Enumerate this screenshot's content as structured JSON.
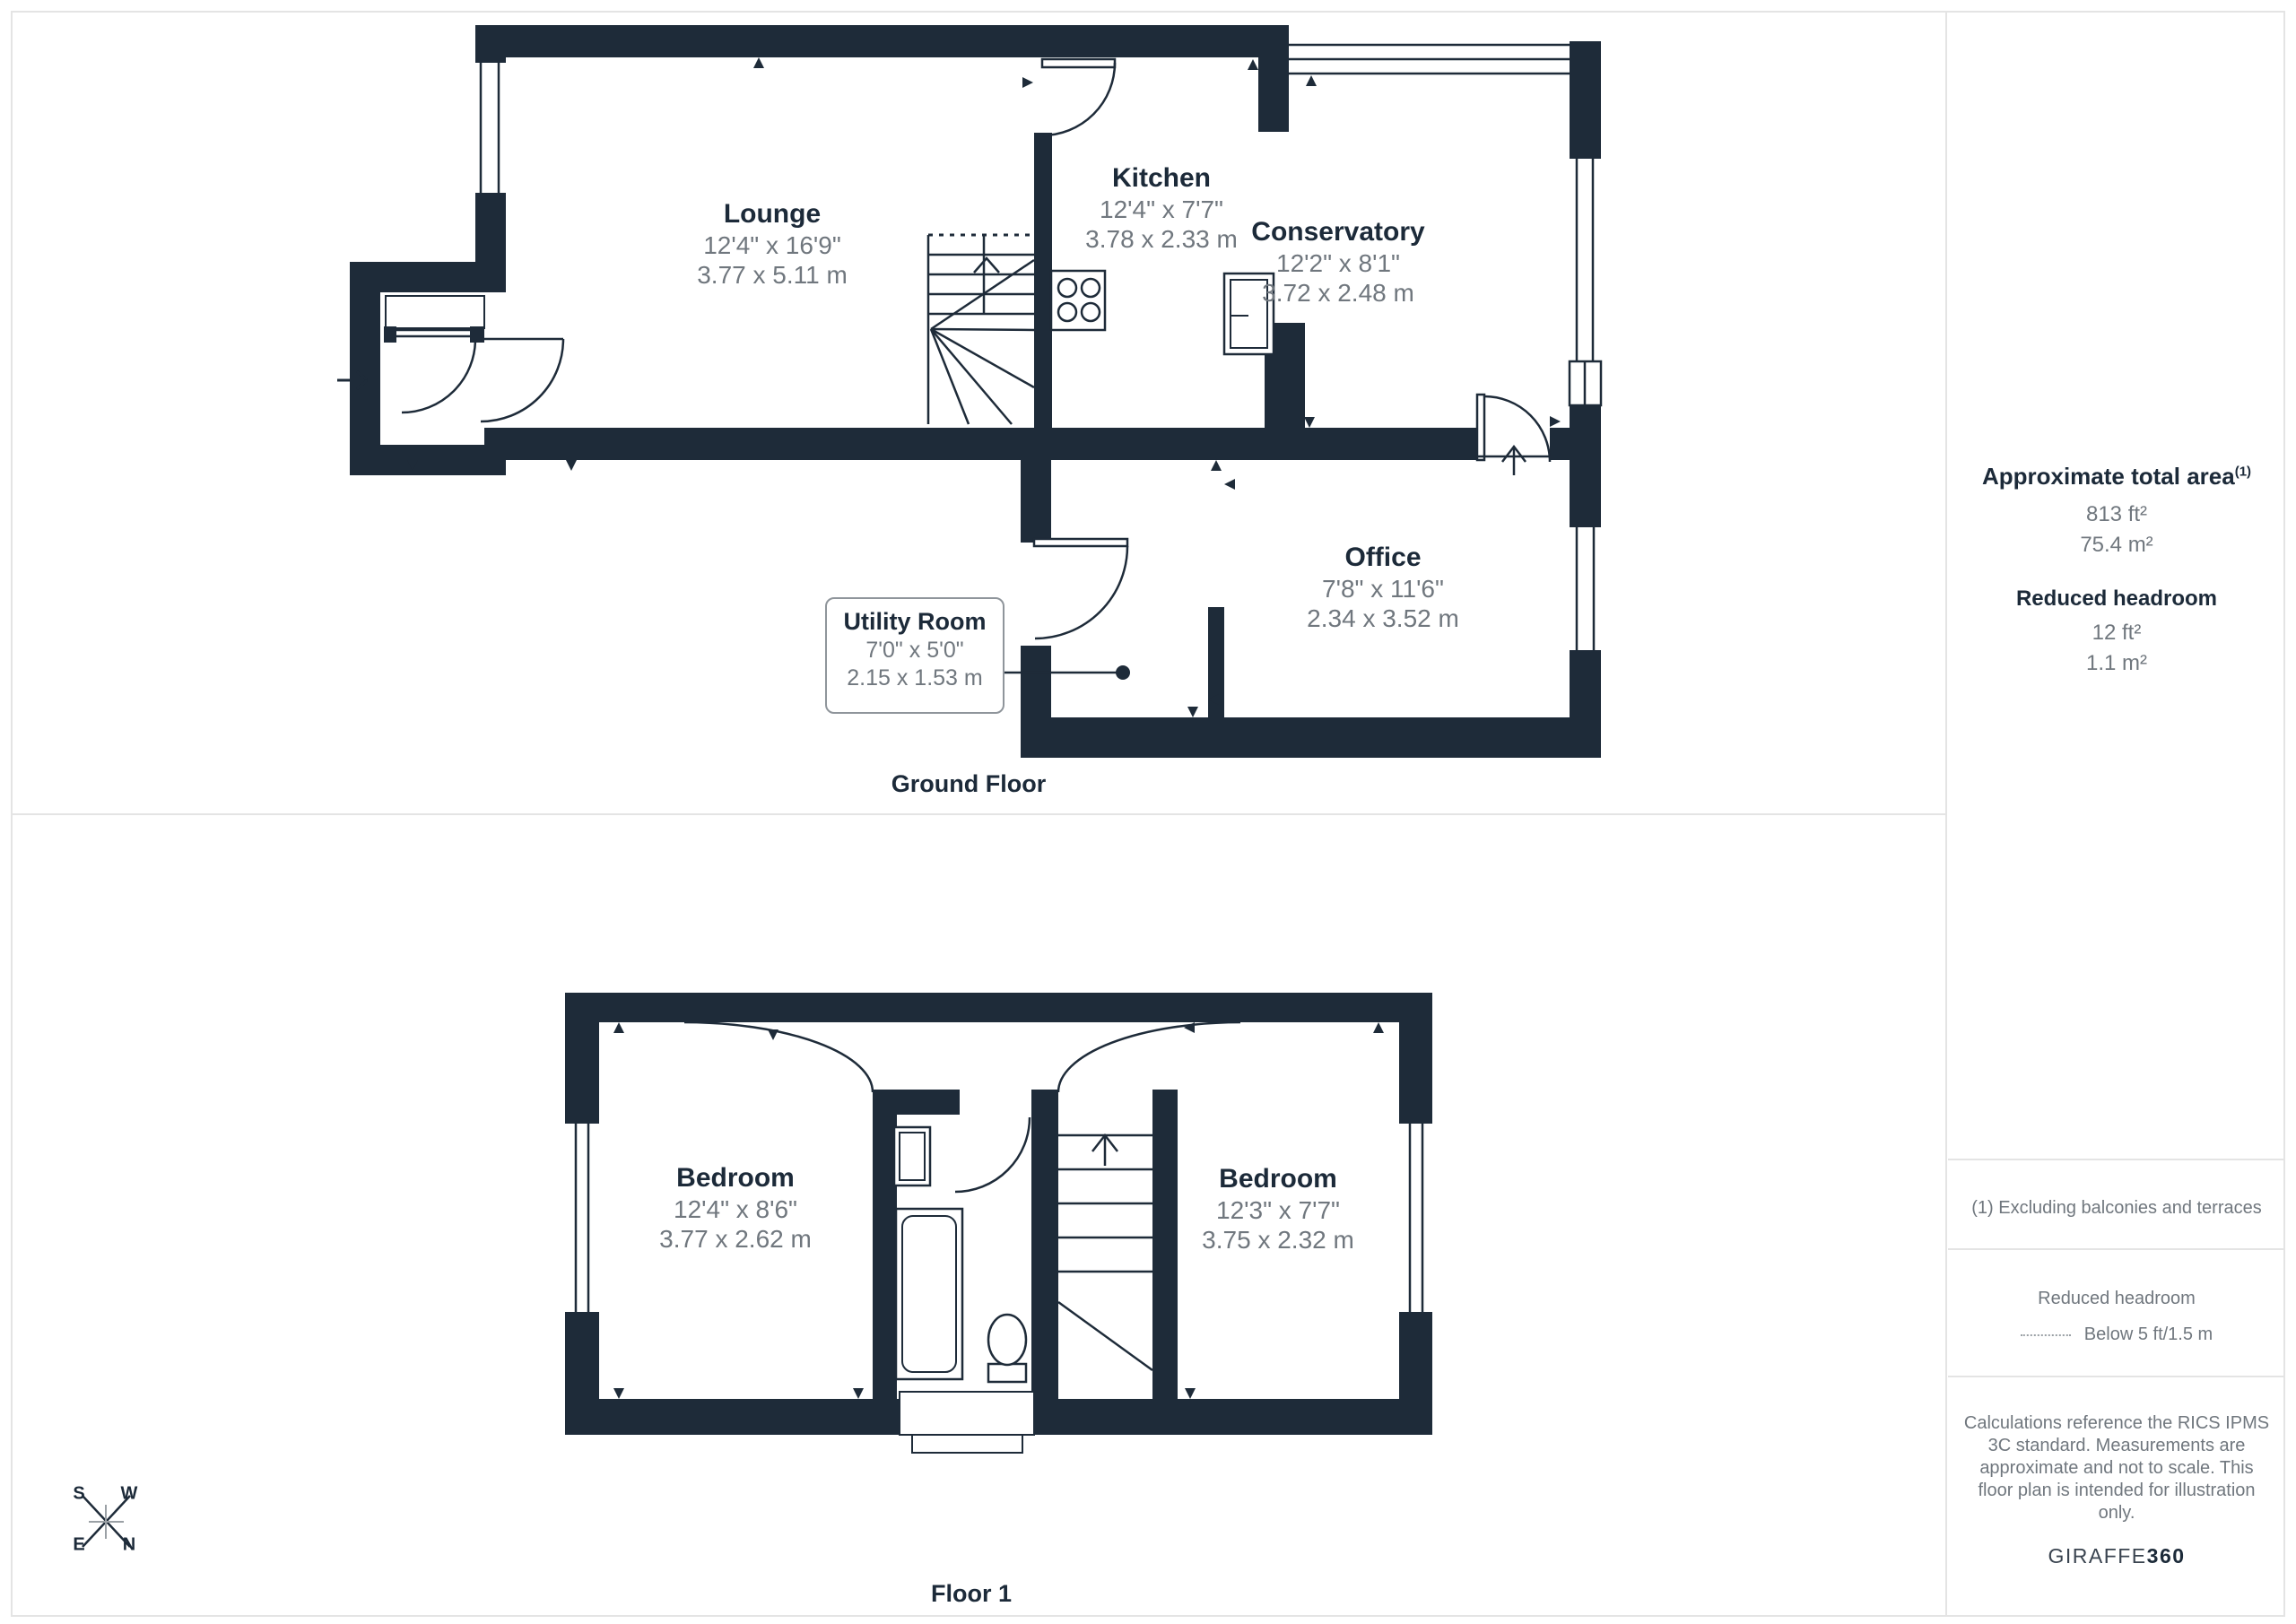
{
  "ground_floor": {
    "label": "Ground Floor",
    "rooms": {
      "lounge": {
        "name": "Lounge",
        "imperial": "12'4\" x 16'9\"",
        "metric": "3.77 x 5.11 m"
      },
      "kitchen": {
        "name": "Kitchen",
        "imperial": "12'4\" x 7'7\"",
        "metric": "3.78 x 2.33 m"
      },
      "conservatory": {
        "name": "Conservatory",
        "imperial": "12'2\" x 8'1\"",
        "metric": "3.72 x 2.48 m"
      },
      "office": {
        "name": "Office",
        "imperial": "7'8\" x 11'6\"",
        "metric": "2.34 x 3.52 m"
      },
      "utility": {
        "name": "Utility Room",
        "imperial": "7'0\" x 5'0\"",
        "metric": "2.15 x 1.53 m"
      }
    }
  },
  "floor_1": {
    "label": "Floor 1",
    "rooms": {
      "bedroom_left": {
        "name": "Bedroom",
        "imperial": "12'4\" x 8'6\"",
        "metric": "3.77 x 2.62 m"
      },
      "bedroom_right": {
        "name": "Bedroom",
        "imperial": "12'3\" x 7'7\"",
        "metric": "3.75 x 2.32 m"
      }
    }
  },
  "sidebar": {
    "total_area": {
      "heading": "Approximate total area",
      "footnote_marker": "(1)",
      "imperial": "813 ft²",
      "metric": "75.4 m²"
    },
    "reduced_headroom": {
      "heading": "Reduced headroom",
      "imperial": "12 ft²",
      "metric": "1.1 m²"
    },
    "footnote": "(1) Excluding balconies and terraces",
    "legend": {
      "title": "Reduced headroom",
      "entry": "Below 5 ft/1.5 m"
    },
    "disclaimer": "Calculations reference the RICS IPMS 3C standard. Measurements are approximate and not to scale. This floor plan is intended for illustration only.",
    "brand": {
      "regular": "GIRAFFE",
      "bold": "360"
    }
  },
  "compass": {
    "s": "S",
    "w": "W",
    "e": "E",
    "n": "N"
  },
  "colors": {
    "wall": "#1E2B39",
    "text_dark": "#1C2A39",
    "text_gray": "#70777E",
    "divider": "#E4E4E4"
  }
}
